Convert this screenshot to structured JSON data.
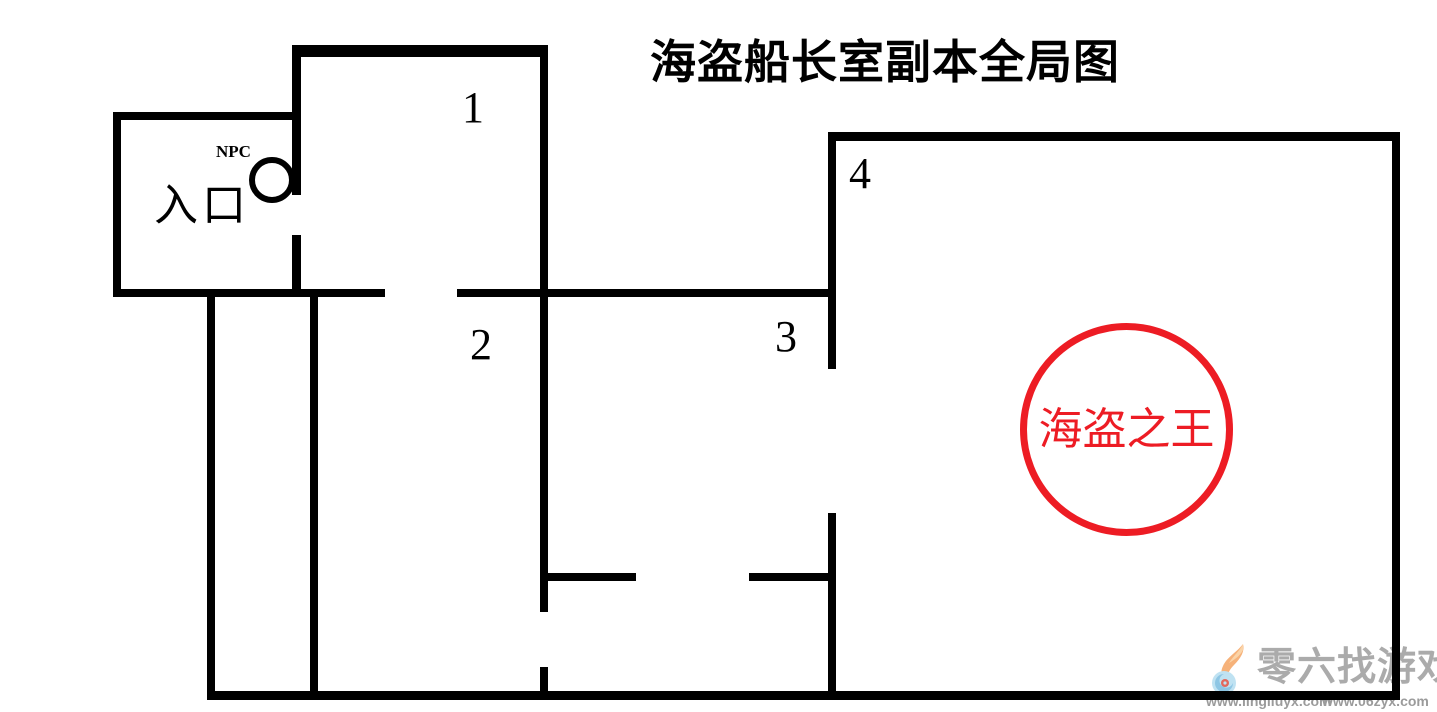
{
  "title": "海盗船长室副本全局图",
  "map": {
    "room_labels": [
      {
        "id": "room-1",
        "text": "1"
      },
      {
        "id": "room-2",
        "text": "2"
      },
      {
        "id": "room-3",
        "text": "3"
      },
      {
        "id": "room-4",
        "text": "4"
      }
    ],
    "entrance_label": "入口",
    "npc_label": "NPC",
    "boss_label": "海盗之王",
    "colors": {
      "wall": "#000000",
      "boss_red": "#ed1c24"
    },
    "walls": [
      {
        "x": 293,
        "y": 45,
        "w": 255,
        "h": 12
      },
      {
        "x": 113,
        "y": 112,
        "w": 188,
        "h": 8
      },
      {
        "x": 113,
        "y": 289,
        "w": 272,
        "h": 8
      },
      {
        "x": 457,
        "y": 289,
        "w": 378,
        "h": 8
      },
      {
        "x": 830,
        "y": 132,
        "w": 570,
        "h": 9
      },
      {
        "x": 545,
        "y": 573,
        "w": 91,
        "h": 8
      },
      {
        "x": 749,
        "y": 573,
        "w": 87,
        "h": 8
      },
      {
        "x": 207,
        "y": 691,
        "w": 1193,
        "h": 9
      },
      {
        "x": 113,
        "y": 112,
        "w": 8,
        "h": 185
      },
      {
        "x": 292,
        "y": 45,
        "w": 9,
        "h": 150
      },
      {
        "x": 292,
        "y": 235,
        "w": 9,
        "h": 62
      },
      {
        "x": 207,
        "y": 293,
        "w": 8,
        "h": 403
      },
      {
        "x": 310,
        "y": 293,
        "w": 8,
        "h": 403
      },
      {
        "x": 540,
        "y": 45,
        "w": 8,
        "h": 567
      },
      {
        "x": 540,
        "y": 667,
        "w": 8,
        "h": 30
      },
      {
        "x": 828,
        "y": 132,
        "w": 8,
        "h": 237
      },
      {
        "x": 828,
        "y": 513,
        "w": 8,
        "h": 183
      },
      {
        "x": 1392,
        "y": 132,
        "w": 8,
        "h": 565
      }
    ]
  },
  "watermark": {
    "brand": "零六找游戏",
    "url_left": "www.lingliuyx.com",
    "url_right": "www.06zyx.com",
    "brand_color": "#ababab",
    "url_color": "#9b9b9b"
  }
}
